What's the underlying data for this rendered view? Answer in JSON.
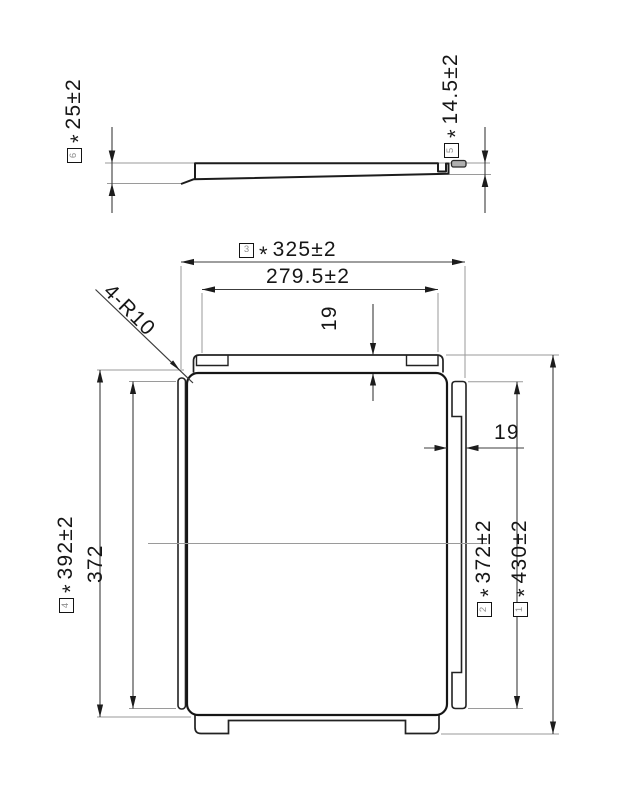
{
  "side_view": {
    "dim_left": {
      "balloon": "6",
      "star": "*",
      "value": "25±2"
    },
    "dim_right": {
      "balloon": "5",
      "star": "*",
      "value": "14.5±2"
    }
  },
  "plan_view": {
    "width_overall": {
      "balloon": "3",
      "star": "*",
      "value": "325±2"
    },
    "width_tabs": {
      "value": "279.5±2"
    },
    "flange_depth_top": {
      "value": "19"
    },
    "pad_width_right": {
      "value": "19"
    },
    "corner_radius_note": {
      "value": "4-R10"
    },
    "height_left_outer": {
      "balloon": "4",
      "star": "*",
      "value": "392±2"
    },
    "height_left_inner": {
      "value": "372"
    },
    "height_right_inner": {
      "balloon": "2",
      "star": "*",
      "value": "372±2"
    },
    "height_overall": {
      "balloon": "1",
      "star": "*",
      "value": "430±2"
    }
  }
}
